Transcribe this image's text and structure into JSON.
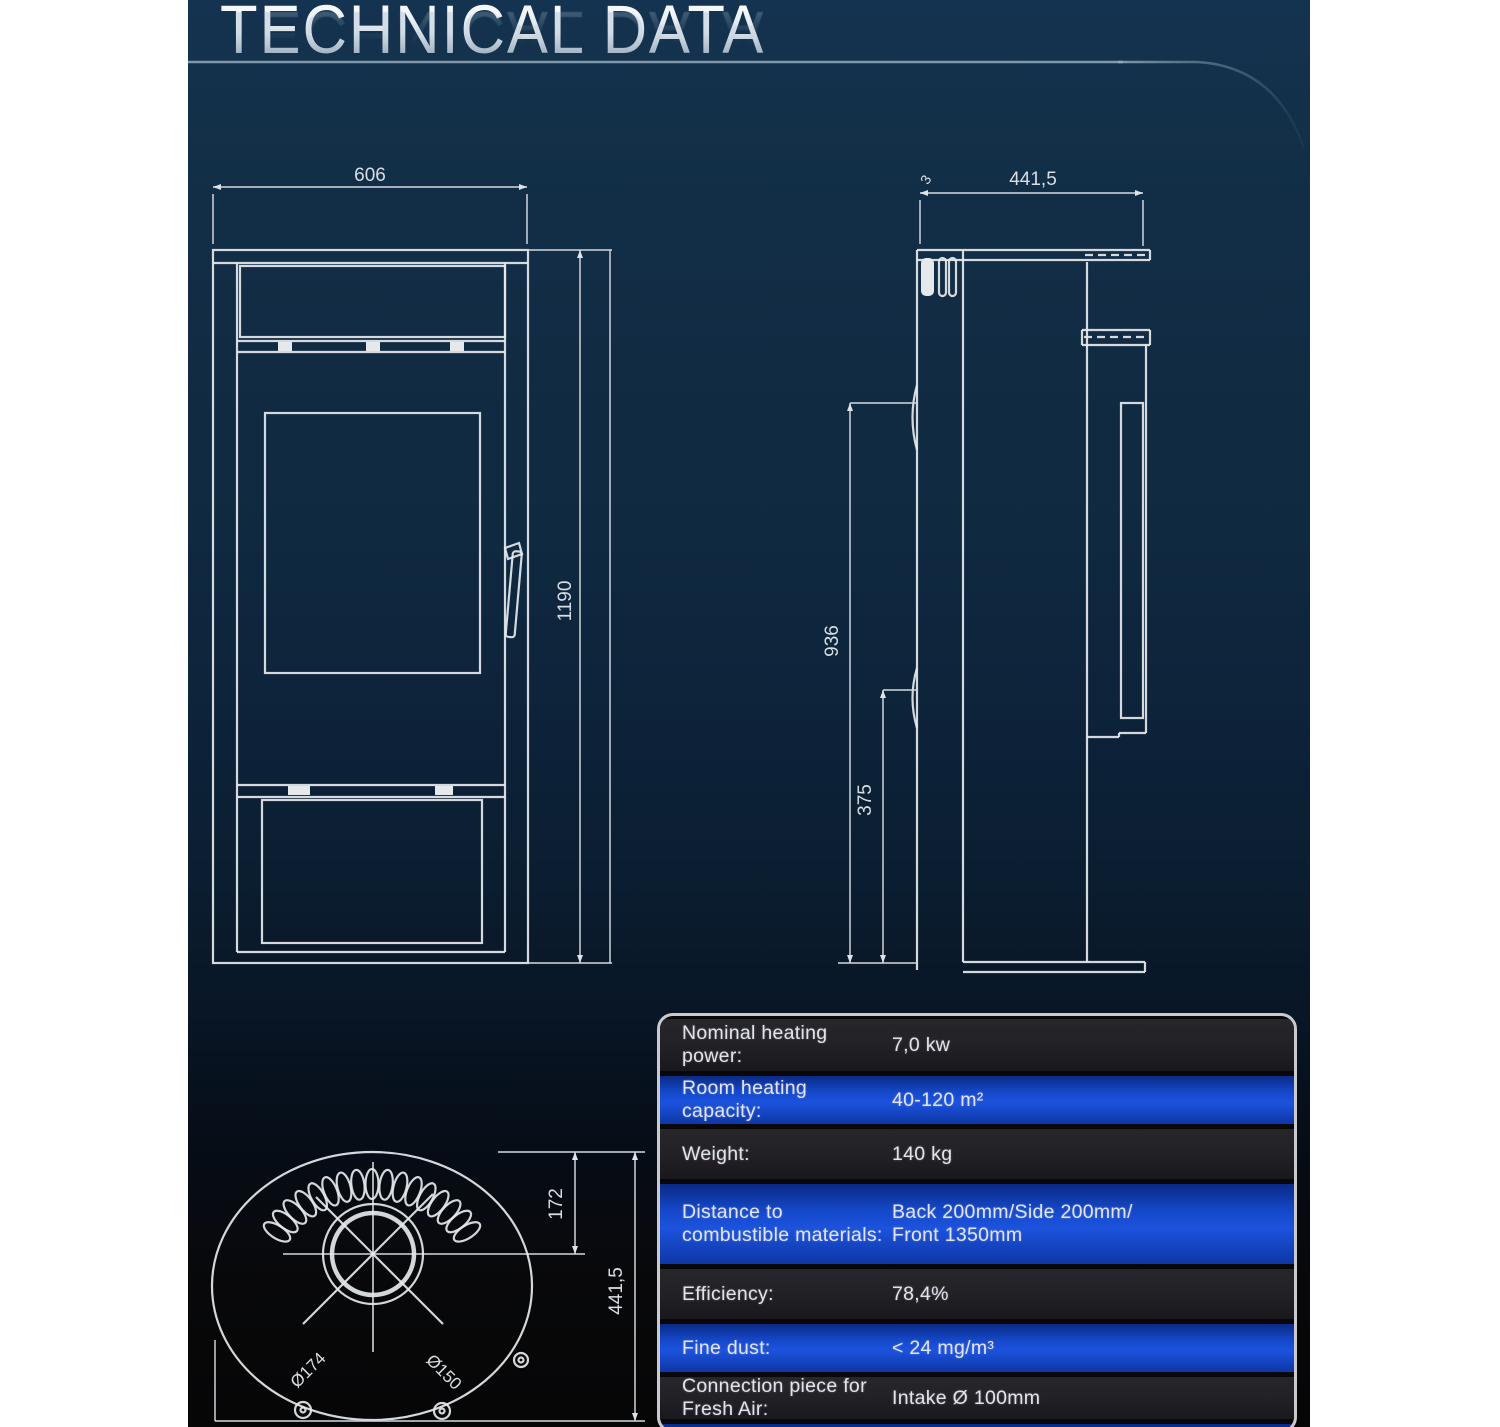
{
  "page": {
    "title": "TECHNICAL DATA"
  },
  "front_view": {
    "width": "606",
    "height": "1190"
  },
  "side_view": {
    "depth": "441,5",
    "top_inset": "3",
    "upper_height": "936",
    "lower_height": "375"
  },
  "top_view": {
    "flue_outer_diameter": "Ø174",
    "flue_inner_diameter": "Ø150",
    "flue_center_offset": "172",
    "depth": "441,5"
  },
  "spec_table": {
    "rows": [
      {
        "label": "Nominal heating power:",
        "value": "7,0 kw"
      },
      {
        "label": "Room heating capacity:",
        "value": "40-120 m²"
      },
      {
        "label": "Weight:",
        "value": "140 kg"
      },
      {
        "label": "Distance to combustible materials:",
        "value": "Back 200mm/Side 200mm/",
        "value2": "Front 1350mm"
      },
      {
        "label": "Efficiency:",
        "value": "78,4%"
      },
      {
        "label": "Fine dust:",
        "value": "< 24 mg/m³"
      },
      {
        "label": "Connection piece for Fresh Air:",
        "value": "Intake Ø 100mm"
      }
    ]
  }
}
